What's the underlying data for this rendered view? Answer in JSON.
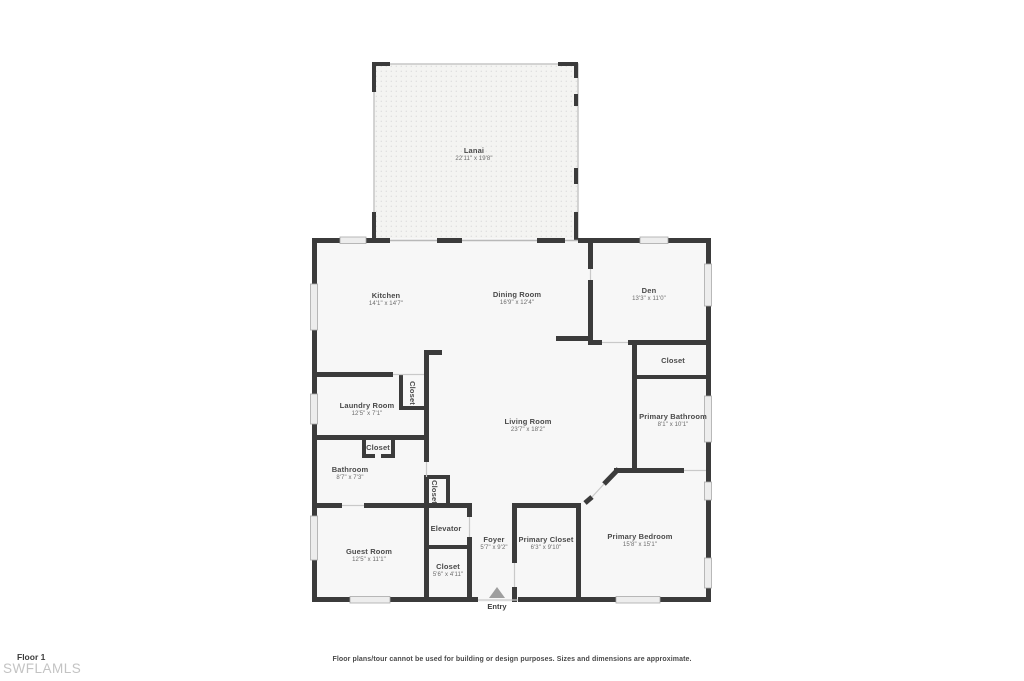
{
  "footer": {
    "floor_label": "Floor 1",
    "brand": "SWFLAMLS",
    "disclaimer": "Floor plans/tour cannot be used for building or design purposes. Sizes and dimensions are approximate."
  },
  "colors": {
    "wall": "#3b3b3b",
    "room_fill": "#f7f7f7",
    "lanai_fill": "#f4f4f2",
    "lanai_dot": "#dcdcdc",
    "window_fill": "#ededed",
    "window_frame": "#a8a8a8",
    "door_line": "#c9c9c9",
    "label_text": "#4a4a4a",
    "dims_text": "#6b6b6b",
    "entry_arrow": "#9e9e9e",
    "brand_text": "#c3c3c3"
  },
  "rooms": {
    "lanai": {
      "name": "Lanai",
      "dims": "22'11\" x 19'8\""
    },
    "kitchen": {
      "name": "Kitchen",
      "dims": "14'1\" x 14'7\""
    },
    "dining": {
      "name": "Dining Room",
      "dims": "16'9\" x 12'4\""
    },
    "den": {
      "name": "Den",
      "dims": "13'3\" x 11'0\""
    },
    "den_closet": {
      "name": "Closet"
    },
    "laundry": {
      "name": "Laundry Room",
      "dims": "12'5\" x 7'1\""
    },
    "laundry_closet": {
      "name": "Closet"
    },
    "living": {
      "name": "Living Room",
      "dims": "23'7\" x 18'2\""
    },
    "primary_bath": {
      "name": "Primary Bathroom",
      "dims": "8'1\" x 10'1\""
    },
    "bath_closet": {
      "name": "Closet"
    },
    "bathroom": {
      "name": "Bathroom",
      "dims": "8'7\" x 7'3\""
    },
    "hall_closet": {
      "name": "Closet"
    },
    "elevator": {
      "name": "Elevator"
    },
    "foyer": {
      "name": "Foyer",
      "dims": "5'7\" x 9'2\""
    },
    "primary_closet": {
      "name": "Primary Closet",
      "dims": "6'3\" x 9'10\""
    },
    "primary_bedroom": {
      "name": "Primary Bedroom",
      "dims": "15'8\" x 15'1\""
    },
    "guest": {
      "name": "Guest Room",
      "dims": "12'5\" x 11'1\""
    },
    "guest_closet": {
      "name": "Closet",
      "dims": "5'6\" x 4'11\""
    },
    "entry": {
      "name": "Entry"
    }
  }
}
